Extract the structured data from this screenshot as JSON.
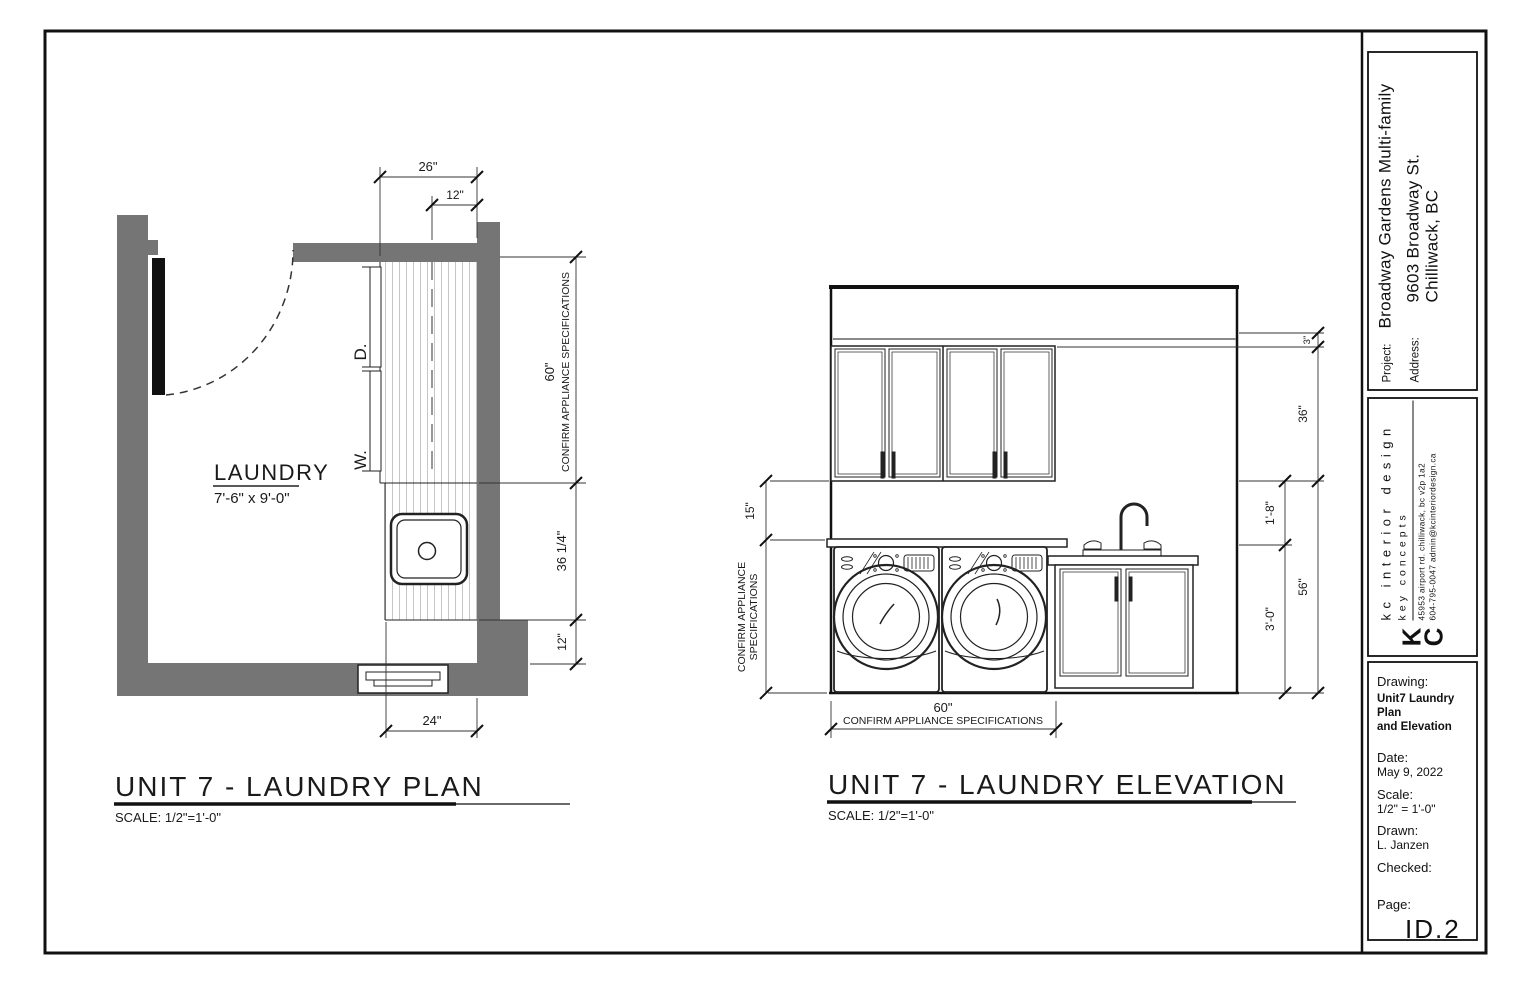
{
  "plan": {
    "title": "UNIT 7 - LAUNDRY PLAN",
    "scale": "SCALE: 1/2\"=1'-0\"",
    "room_name": "LAUNDRY",
    "room_size": "7'-6\" x 9'-0\"",
    "dryer_label": "D.",
    "washer_label": "W.",
    "dim_top_26": "26\"",
    "dim_top_12": "12\"",
    "dim_right_60": "60\"",
    "dim_right_60_note": "CONFIRM APPLIANCE SPECIFICATIONS",
    "dim_right_36": "36 1/4\"",
    "dim_right_12": "12\"",
    "dim_bottom_24": "24\""
  },
  "elevation": {
    "title": "UNIT 7 - LAUNDRY ELEVATION",
    "scale": "SCALE: 1/2\"=1'-0\"",
    "dim_left_15": "15\"",
    "dim_left_note1": "CONFIRM APPLIANCE",
    "dim_left_note2": "SPECIFICATIONS",
    "dim_bottom_60": "60\"",
    "dim_bottom_note": "CONFIRM APPLIANCE SPECIFICATIONS",
    "dim_right_3": "3\"",
    "dim_right_36": "36\"",
    "dim_right_1_8": "1'-8\"",
    "dim_right_56": "56\"",
    "dim_right_3_0": "3'-0\""
  },
  "title_block": {
    "project_label": "Project:",
    "project": "Broadway Gardens Multi-family",
    "address_label": "Address:",
    "address_line1": "9603 Broadway St.",
    "address_line2": "Chilliwack, BC",
    "logo_k": "K",
    "logo_c": "C",
    "firm_name": "kc interior design",
    "firm_tagline": "key concepts",
    "firm_address": "45953 airport rd. chilliwack, bc  v2p 1a2",
    "firm_contact": "604-795-0047    admin@kcinteriordesign.ca",
    "drawing_label": "Drawing:",
    "drawing_line1": "Unit7 Laundry Plan",
    "drawing_line2": "and Elevation",
    "date_label": "Date:",
    "date_value": "May 9, 2022",
    "scale_label": "Scale:",
    "scale_value": "1/2\" = 1'-0\"",
    "drawn_label": "Drawn:",
    "drawn_value": "L. Janzen",
    "checked_label": "Checked:",
    "page_label": "Page:",
    "page_value": "ID.2"
  }
}
